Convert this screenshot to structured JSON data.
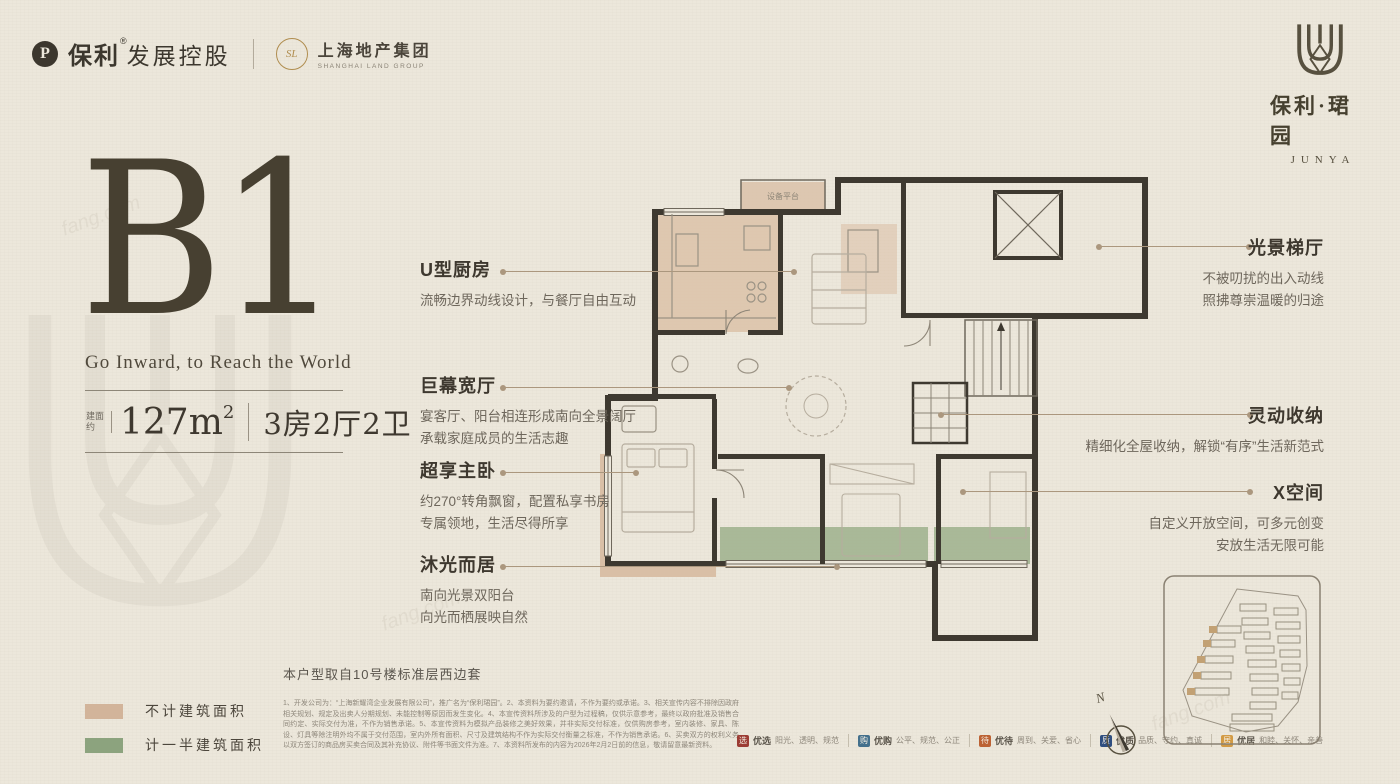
{
  "header": {
    "brand_left": {
      "logo_char": "P",
      "name": "保利",
      "reg": "®",
      "suffix": "发展控股"
    },
    "brand_left2": {
      "badge": "SL",
      "name": "上海地产集团",
      "sub": "SHANGHAI LAND GROUP"
    },
    "brand_right": {
      "name": "保利·珺园",
      "sub": "JUNYA"
    }
  },
  "hero": {
    "unit": "B1",
    "tagline": "Go Inward, to Reach the World",
    "area_label": "建面约",
    "area_value": "127m",
    "area_sup": "2",
    "layout": "3房2厅2卫"
  },
  "annotations_left": [
    {
      "title": "U型厨房",
      "lines": [
        "流畅边界动线设计，与餐厅自由互动"
      ]
    },
    {
      "title": "巨幕宽厅",
      "lines": [
        "宴客厅、阳台相连形成南向全景阔厅",
        "承载家庭成员的生活志趣"
      ]
    },
    {
      "title": "超享主卧",
      "lines": [
        "约270°转角飘窗，配置私享书房",
        "专属领地，生活尽得所享"
      ]
    },
    {
      "title": "沐光而居",
      "lines": [
        "南向光景双阳台",
        "向光而栖展映自然"
      ]
    }
  ],
  "annotations_right": [
    {
      "title": "光景梯厅",
      "lines": [
        "不被叨扰的出入动线",
        "照拂尊崇温暖的归途"
      ]
    },
    {
      "title": "灵动收纳",
      "lines": [
        "精细化全屋收纳，解锁“有序”生活新范式"
      ]
    },
    {
      "title": "X空间",
      "lines": [
        "自定义开放空间，可多元创变",
        "安放生活无限可能"
      ]
    }
  ],
  "plan": {
    "platform_label": "设备平台"
  },
  "legend": [
    {
      "color": "#d2b49a",
      "label": "不计建筑面积"
    },
    {
      "color": "#8ca37e",
      "label": "计一半建筑面积"
    }
  ],
  "footnote": "本户型取自10号楼标准层西边套",
  "disclaimer": "1、开发公司为：“上海新耀湾企业发展有限公司”，推广名为“保利珺园”。2、本资料为要约邀请，不作为要约或承诺。3、相关宣传内容不排除因政府相关规划、规定及出卖人分期规划、未能控制等原因而发生变化。4、本宣传资料所涉及的户型为过程稿，仅供示意参考，最终以政府批准及销售合同约定、实际交付为准，不作为销售承诺。5、本宣传资料为模拟产品装修之美好效果，并非实际交付标准，仅供购房参考，室内装修、家具、陈设、灯具等除注明外均不属于交付范围，室内外所有面积、尺寸及建筑结构不作为实际交付衡量之标准，不作为销售承诺。6、买卖双方的权利义务以双方签订的商品房买卖合同及其补充协议、附件等书面文件为准。7、本资料所发布的内容为2026年2月2日前的信息，敬请留意最新资料。",
  "badges": [
    {
      "color": "#9c3c34",
      "icon_char": "选",
      "name": "优选",
      "desc": "阳光、透明、规范"
    },
    {
      "color": "#44708c",
      "icon_char": "购",
      "name": "优购",
      "desc": "公平、规范、公正"
    },
    {
      "color": "#bc6234",
      "icon_char": "待",
      "name": "优待",
      "desc": "周到、关爱、省心"
    },
    {
      "color": "#2f4e80",
      "icon_char": "质",
      "name": "优质",
      "desc": "品质、守约、真诚"
    },
    {
      "color": "#d29a44",
      "icon_char": "居",
      "name": "优居",
      "desc": "和睦、关怀、亲善"
    }
  ],
  "compass": {
    "label": "N"
  },
  "watermark": "fang.com"
}
